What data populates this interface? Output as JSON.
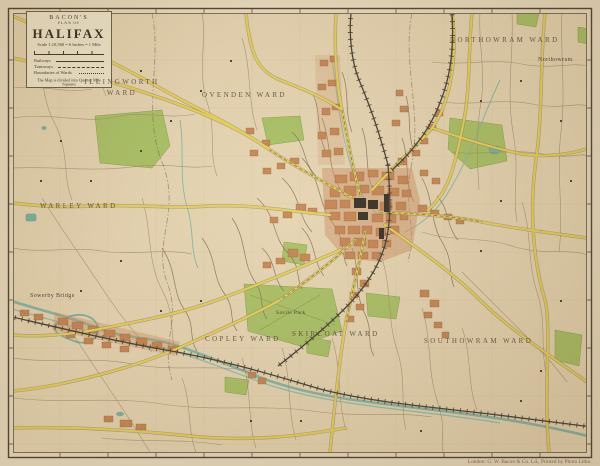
{
  "title_block": {
    "publisher": "BACON'S",
    "plan_of": "PLAN OF",
    "title": "HALIFAX",
    "scale_text": "Scale 1:10,560 = 6 Inches = 1 Mile",
    "legend": [
      {
        "label": "Railways"
      },
      {
        "label": "Tramways"
      },
      {
        "label": "Boundaries of Wards"
      }
    ],
    "note": "The Map is divided into Quarter Mile Squares"
  },
  "wards": [
    {
      "text": "ILLINGWORTH WARD"
    },
    {
      "text": "OVENDEN WARD"
    },
    {
      "text": "NORTHOWRAM WARD"
    },
    {
      "text": "WARLEY WARD"
    },
    {
      "text": "SKIRCOAT WARD"
    },
    {
      "text": "COPLEY WARD"
    },
    {
      "text": "SOUTHOWRAM WARD"
    }
  ],
  "places": [
    {
      "text": "Northowram"
    },
    {
      "text": "Savile Park"
    },
    {
      "text": "Sowerby Bridge"
    }
  ],
  "attribution": "London: G. W. Bacon & Co. Ld., Printed by Photo Litho.",
  "colors": {
    "paper": "#ecdfc4",
    "map_ground": "#e8d7b5",
    "main_road_yellow": "#e8d455",
    "park_green": "#a6c161",
    "water_teal": "#7ab3a4",
    "built_up_orange": "#c5824e",
    "civic_black": "#2f2a22",
    "railway": "#3f3930",
    "ink": "#3c3226"
  }
}
